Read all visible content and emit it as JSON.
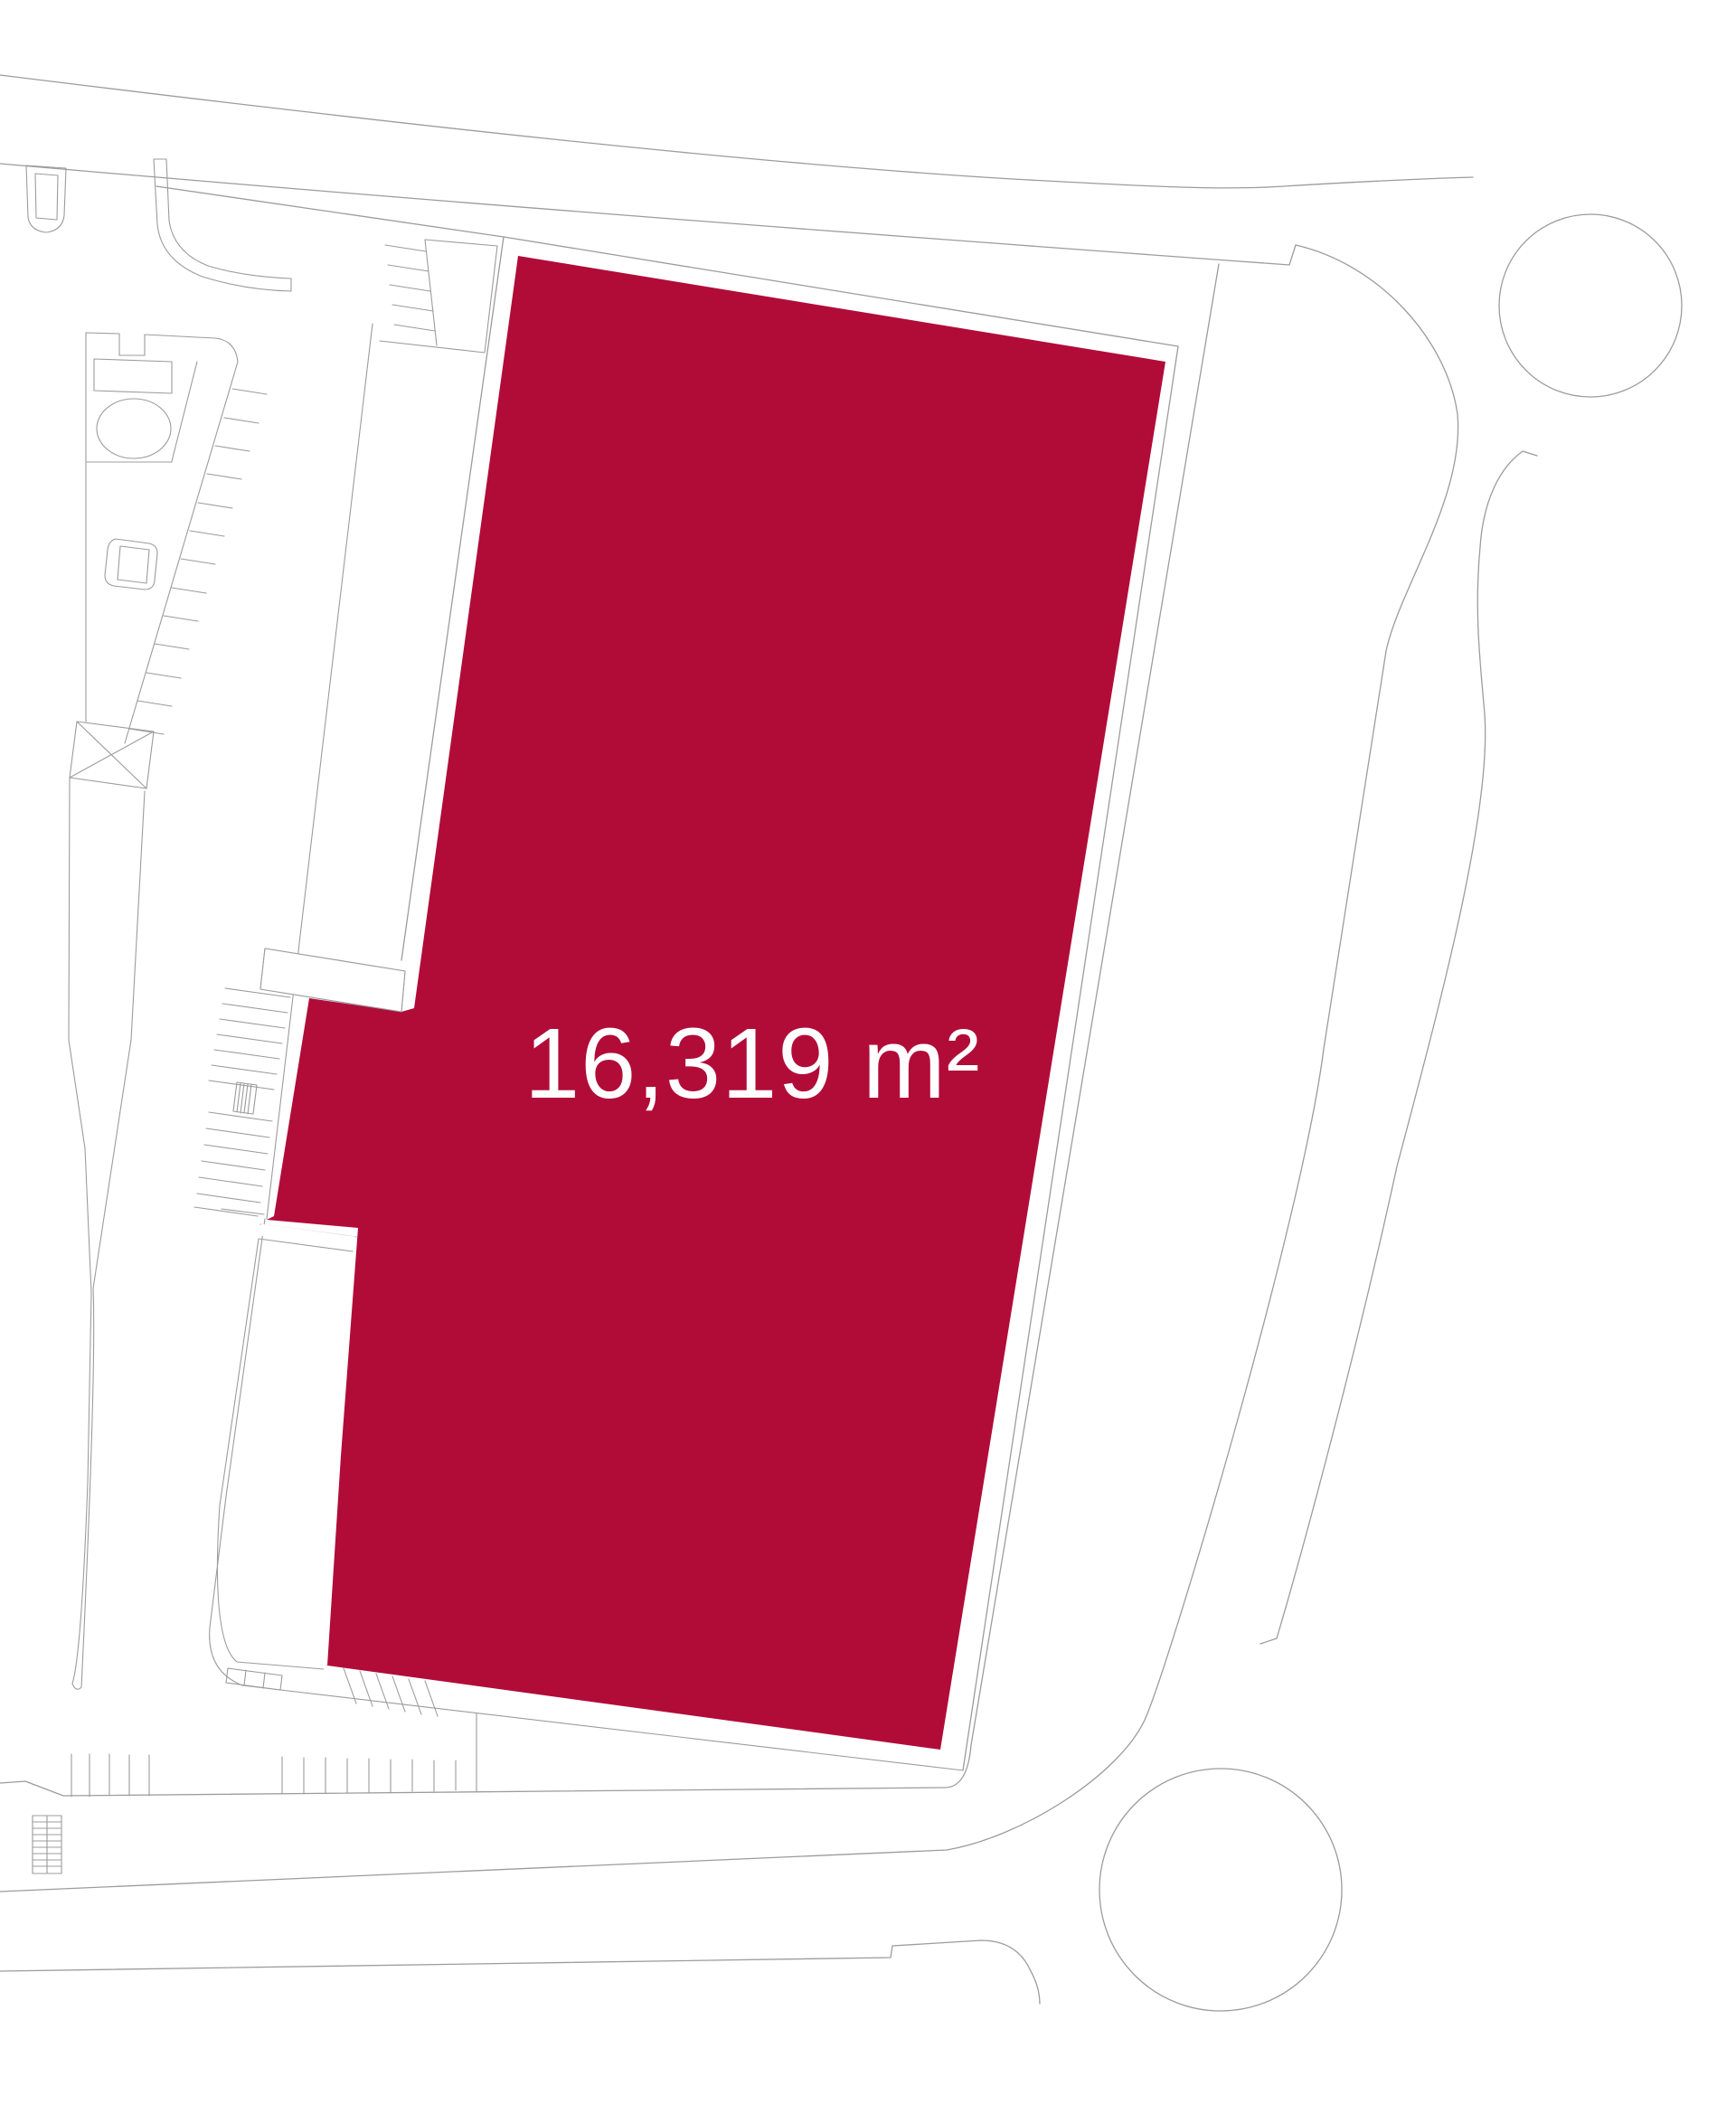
{
  "plan": {
    "title": "Site plan with highlighted plot",
    "plot": {
      "area_label": "16,319 m²",
      "area_value": "16,319",
      "area_unit": "m²"
    }
  },
  "colors": {
    "plot_fill": "#B10C38",
    "plot_label_text": "#FFFFFF",
    "line_work": "#9C9C9C",
    "background": "#FFFFFF"
  }
}
